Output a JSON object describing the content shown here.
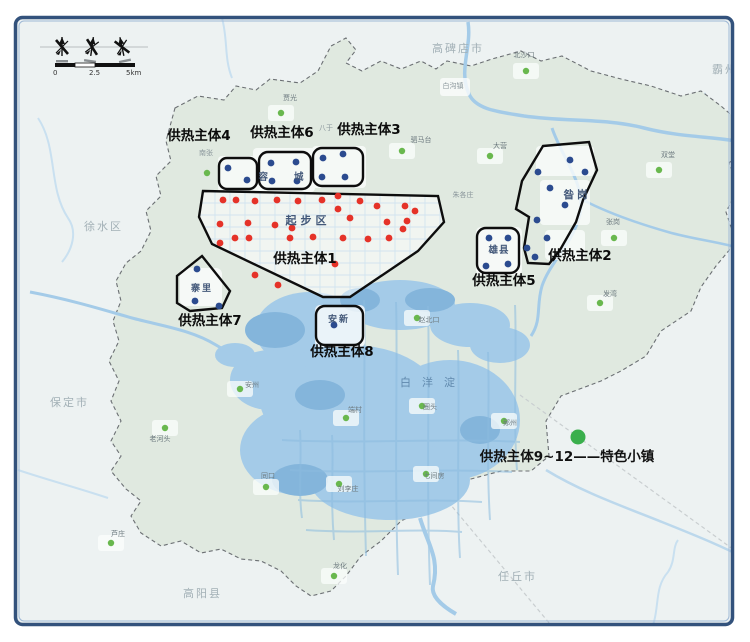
{
  "legend": {
    "label": "供热主体9~12——特色小镇",
    "dot": {
      "x": 578,
      "y": 437,
      "color": "#3aaf4c"
    }
  },
  "scale_bar": {
    "tick_start": "0",
    "tick_mid": "2.5",
    "tick_end": "5km"
  },
  "lake_label": {
    "text": "白洋淀",
    "x": 400,
    "y": 386
  },
  "colors": {
    "red_dot": "#e53228",
    "blue_dot": "#2b4b8f",
    "green_dot": "#69b84e",
    "zone_outline": "#0d0d0d",
    "water": "#a4cbe8",
    "water_deep": "#84b5db",
    "region_fill": "#e0e9e0",
    "frame": "#33527c"
  },
  "cities": [
    {
      "name": "高碑店市",
      "x": 432,
      "y": 52
    },
    {
      "name": "霸州市",
      "x": 712,
      "y": 73
    },
    {
      "name": "徐水区",
      "x": 84,
      "y": 230
    },
    {
      "name": "保定市",
      "x": 50,
      "y": 406
    },
    {
      "name": "高阳县",
      "x": 183,
      "y": 597
    },
    {
      "name": "任丘市",
      "x": 498,
      "y": 580
    }
  ],
  "towns": [
    {
      "name": "白沟镇",
      "x": 453,
      "y": 88
    },
    {
      "name": "南张",
      "x": 206,
      "y": 155
    },
    {
      "name": "八于",
      "x": 326,
      "y": 130
    },
    {
      "name": "朱各庄",
      "x": 463,
      "y": 197
    }
  ],
  "villages": [
    {
      "name": "北沙口",
      "lx": 524,
      "ly": 57,
      "dx": 526,
      "dy": 71
    },
    {
      "name": "贾光",
      "lx": 290,
      "ly": 100,
      "dx": 281,
      "dy": 113
    },
    {
      "name": "驷马台",
      "lx": 421,
      "ly": 142,
      "dx": 402,
      "dy": 151
    },
    {
      "name": "大营",
      "lx": 500,
      "ly": 148,
      "dx": 490,
      "dy": 156
    },
    {
      "name": "双堂",
      "lx": 668,
      "ly": 157,
      "dx": 659,
      "dy": 170
    },
    {
      "name": "张岗",
      "lx": 613,
      "ly": 224,
      "dx": 614,
      "dy": 238
    },
    {
      "name": "发湾",
      "lx": 610,
      "ly": 296,
      "dx": 600,
      "dy": 303
    },
    {
      "name": "赵北口",
      "lx": 429,
      "ly": 322,
      "dx": 417,
      "dy": 318
    },
    {
      "name": "老河头",
      "lx": 160,
      "ly": 441,
      "dx": 165,
      "dy": 428
    },
    {
      "name": "安州",
      "lx": 252,
      "ly": 387,
      "dx": 240,
      "dy": 389
    },
    {
      "name": "端村",
      "lx": 355,
      "ly": 412,
      "dx": 346,
      "dy": 418
    },
    {
      "name": "圈头",
      "lx": 430,
      "ly": 409,
      "dx": 422,
      "dy": 406
    },
    {
      "name": "鄚州",
      "lx": 510,
      "ly": 425,
      "dx": 504,
      "dy": 421
    },
    {
      "name": "同口",
      "lx": 268,
      "ly": 478,
      "dx": 266,
      "dy": 487
    },
    {
      "name": "刘李庄",
      "lx": 348,
      "ly": 491,
      "dx": 339,
      "dy": 484
    },
    {
      "name": "七间房",
      "lx": 434,
      "ly": 478,
      "dx": 426,
      "dy": 474
    },
    {
      "name": "芦庄",
      "lx": 118,
      "ly": 536,
      "dx": 111,
      "dy": 543
    },
    {
      "name": "龙化",
      "lx": 340,
      "ly": 568,
      "dx": 334,
      "dy": 576
    }
  ],
  "extra_green_dots": [
    [
      207,
      173
    ]
  ],
  "zones": [
    {
      "label": "供热主体1",
      "lx": 305,
      "ly": 263,
      "inner": "起步区",
      "ix": 308,
      "iy": 224,
      "ils": 4,
      "isz": 11
    },
    {
      "label": "供热主体2",
      "lx": 580,
      "ly": 260,
      "inner": "昝岗",
      "ix": 577,
      "iy": 198,
      "ils": 3,
      "isz": 10.5
    },
    {
      "label": "供热主体3",
      "lx": 369,
      "ly": 134
    },
    {
      "label": "供热主体4",
      "lx": 199,
      "ly": 140
    },
    {
      "label": "供热主体5",
      "lx": 504,
      "ly": 285,
      "inner": "雄县",
      "ix": 499,
      "iy": 253,
      "ils": 1,
      "isz": 9.5
    },
    {
      "label": "供热主体6",
      "lx": 282,
      "ly": 137,
      "inner": "容城",
      "ix": 294,
      "iy": 180,
      "ils": 26,
      "isz": 9.5
    },
    {
      "label": "供热主体7",
      "lx": 210,
      "ly": 325,
      "inner": "寨里",
      "ix": 202,
      "iy": 291,
      "ils": 2,
      "isz": 9
    },
    {
      "label": "供热主体8",
      "lx": 342,
      "ly": 356,
      "inner": "安新",
      "ix": 339,
      "iy": 322,
      "ils": 2,
      "isz": 9
    }
  ],
  "dots": {
    "red": [
      [
        223,
        200
      ],
      [
        236,
        200
      ],
      [
        255,
        201
      ],
      [
        277,
        200
      ],
      [
        298,
        201
      ],
      [
        322,
        200
      ],
      [
        338,
        196
      ],
      [
        360,
        201
      ],
      [
        377,
        206
      ],
      [
        405,
        206
      ],
      [
        415,
        211
      ],
      [
        338,
        209
      ],
      [
        350,
        218
      ],
      [
        387,
        222
      ],
      [
        407,
        221
      ],
      [
        403,
        229
      ],
      [
        220,
        224
      ],
      [
        248,
        223
      ],
      [
        275,
        225
      ],
      [
        292,
        228
      ],
      [
        235,
        238
      ],
      [
        249,
        238
      ],
      [
        220,
        243
      ],
      [
        290,
        238
      ],
      [
        313,
        237
      ],
      [
        343,
        238
      ],
      [
        368,
        239
      ],
      [
        389,
        238
      ],
      [
        335,
        264
      ],
      [
        255,
        275
      ],
      [
        278,
        285
      ]
    ],
    "blue": [
      [
        228,
        168
      ],
      [
        247,
        180
      ],
      [
        271,
        163
      ],
      [
        296,
        162
      ],
      [
        272,
        181
      ],
      [
        297,
        181
      ],
      [
        323,
        158
      ],
      [
        343,
        154
      ],
      [
        322,
        177
      ],
      [
        345,
        177
      ],
      [
        197,
        269
      ],
      [
        195,
        301
      ],
      [
        219,
        306
      ],
      [
        334,
        325
      ],
      [
        489,
        238
      ],
      [
        508,
        238
      ],
      [
        486,
        266
      ],
      [
        508,
        264
      ],
      [
        570,
        160
      ],
      [
        538,
        172
      ],
      [
        585,
        172
      ],
      [
        550,
        188
      ],
      [
        565,
        205
      ],
      [
        537,
        220
      ],
      [
        547,
        238
      ],
      [
        527,
        248
      ],
      [
        535,
        257
      ]
    ]
  }
}
